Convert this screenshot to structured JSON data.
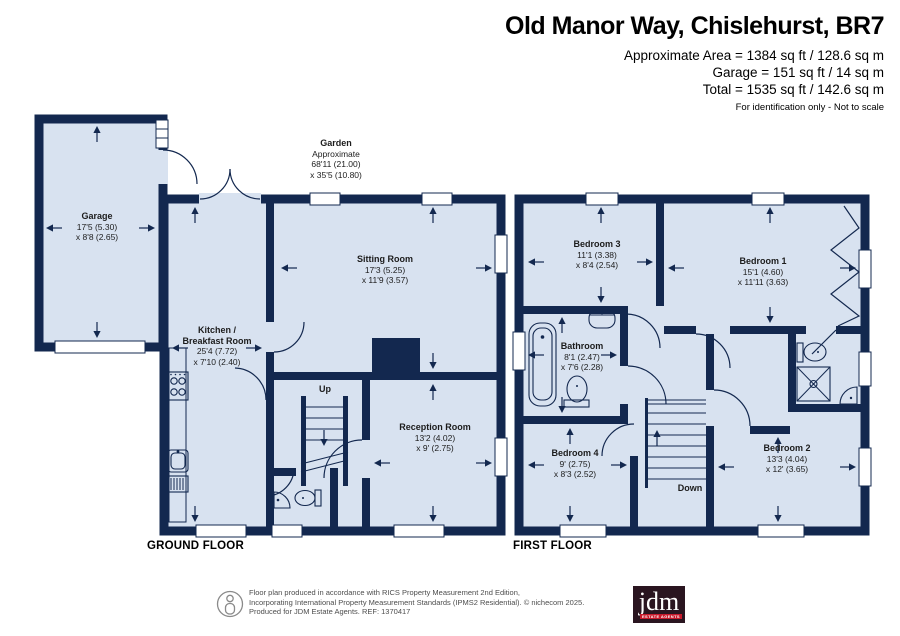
{
  "header": {
    "title": "Old Manor Way, Chislehurst, BR7",
    "area_line": "Approximate Area = 1384 sq ft / 128.6 sq m",
    "garage_line": "Garage = 151 sq ft / 14 sq m",
    "total_line": "Total = 1535 sq ft / 142.6 sq m",
    "note": "For identification only - Not to scale"
  },
  "garden": {
    "name": "Garden",
    "line1": "Approximate",
    "line2": "68'11 (21.00)",
    "line3": "x 35'5 (10.80)"
  },
  "rooms": {
    "garage": {
      "name": "Garage",
      "dim1": "17'5 (5.30)",
      "dim2": "x 8'8 (2.65)"
    },
    "kitchen": {
      "name1": "Kitchen /",
      "name2": "Breakfast Room",
      "dim1": "25'4 (7.72)",
      "dim2": "x 7'10 (2.40)"
    },
    "sitting": {
      "name": "Sitting Room",
      "dim1": "17'3 (5.25)",
      "dim2": "x 11'9 (3.57)"
    },
    "reception": {
      "name": "Reception Room",
      "dim1": "13'2 (4.02)",
      "dim2": "x 9' (2.75)"
    },
    "bedroom3": {
      "name": "Bedroom 3",
      "dim1": "11'1 (3.38)",
      "dim2": "x 8'4 (2.54)"
    },
    "bedroom1": {
      "name": "Bedroom 1",
      "dim1": "15'1 (4.60)",
      "dim2": "x 11'11 (3.63)"
    },
    "bathroom": {
      "name": "Bathroom",
      "dim1": "8'1 (2.47)",
      "dim2": "x 7'6 (2.28)"
    },
    "bedroom4": {
      "name": "Bedroom 4",
      "dim1": "9' (2.75)",
      "dim2": "x 8'3 (2.52)"
    },
    "bedroom2": {
      "name": "Bedroom 2",
      "dim1": "13'3 (4.04)",
      "dim2": "x 12' (3.65)"
    }
  },
  "stairs": {
    "up": "Up",
    "down": "Down"
  },
  "floors": {
    "ground": "GROUND FLOOR",
    "first": "FIRST FLOOR"
  },
  "footer": {
    "line1": "Floor plan produced in accordance with RICS Property Measurement 2nd Edition,",
    "line2": "Incorporating International Property Measurement Standards (IPMS2 Residential).  © nichecom 2025.",
    "line3": "Produced for JDM Estate Agents.  REF: 1370417",
    "logo_word": "jdm",
    "logo_sub": "ESTATE AGENTS"
  },
  "icons": [
    "person-icon",
    "bathtub-icon",
    "toilet-icon",
    "sink-icon",
    "shower-icon",
    "hob-icon",
    "stairs-icon"
  ],
  "colors": {
    "wall": "#13284F",
    "room_fill": "#D8E2F0",
    "window": "#FFFFFF",
    "logo_bg": "#2A1520",
    "logo_accent": "#C8192B",
    "footer_text": "#4D4D4D"
  }
}
